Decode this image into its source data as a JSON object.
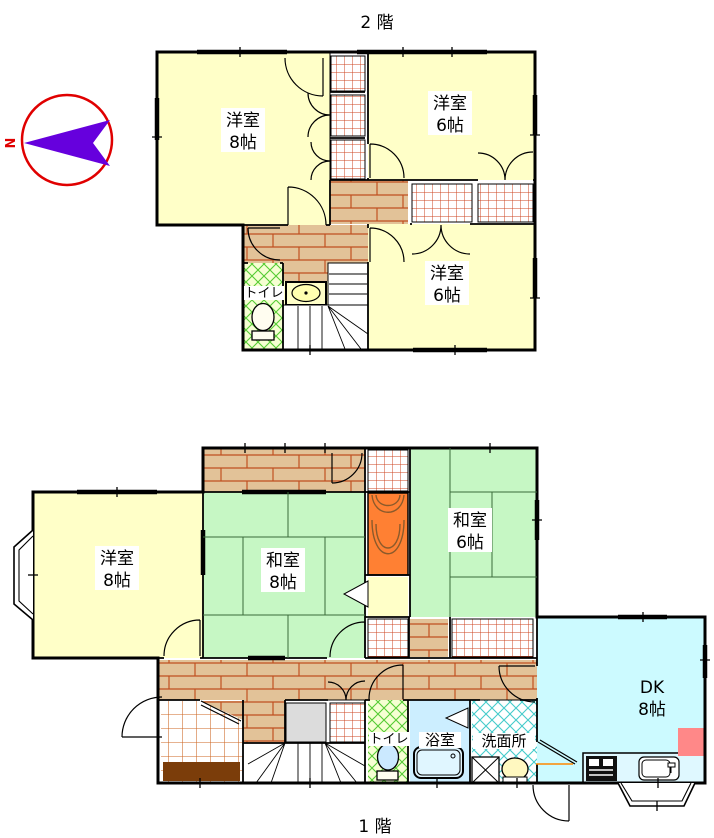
{
  "compass": {
    "north_label": "N"
  },
  "floor2": {
    "title": "2 階",
    "rooms": {
      "west8": {
        "line1": "洋室",
        "line2": "8帖"
      },
      "west6_top": {
        "line1": "洋室",
        "line2": "6帖"
      },
      "west6_bottom": {
        "line1": "洋室",
        "line2": "6帖"
      }
    },
    "toilet_label": "トイレ"
  },
  "floor1": {
    "title": "1 階",
    "rooms": {
      "west8": {
        "line1": "洋室",
        "line2": "8帖"
      },
      "japanese8": {
        "line1": "和室",
        "line2": "8帖"
      },
      "japanese6": {
        "line1": "和室",
        "line2": "6帖"
      },
      "dk": {
        "line1": "DK",
        "line2": "8帖"
      }
    },
    "toilet_label": "トイレ",
    "bath_label": "浴室",
    "washroom_label": "洗面所"
  },
  "legend_colors": {
    "western_room": "#FFFFC8",
    "tatami_room": "#C6F7C4",
    "dining_kitchen": "#CCFAFF",
    "bath_room": "#CCEEFF",
    "hallway_brick": "#E2C298",
    "tokonoma": "#FF8033",
    "toilet_floor": "#F6FFD2",
    "refrigerator": "#FF8888",
    "entrance_step": "#7B3D0A",
    "compass_ring": "#E00000",
    "compass_needle": "#6600DD"
  }
}
